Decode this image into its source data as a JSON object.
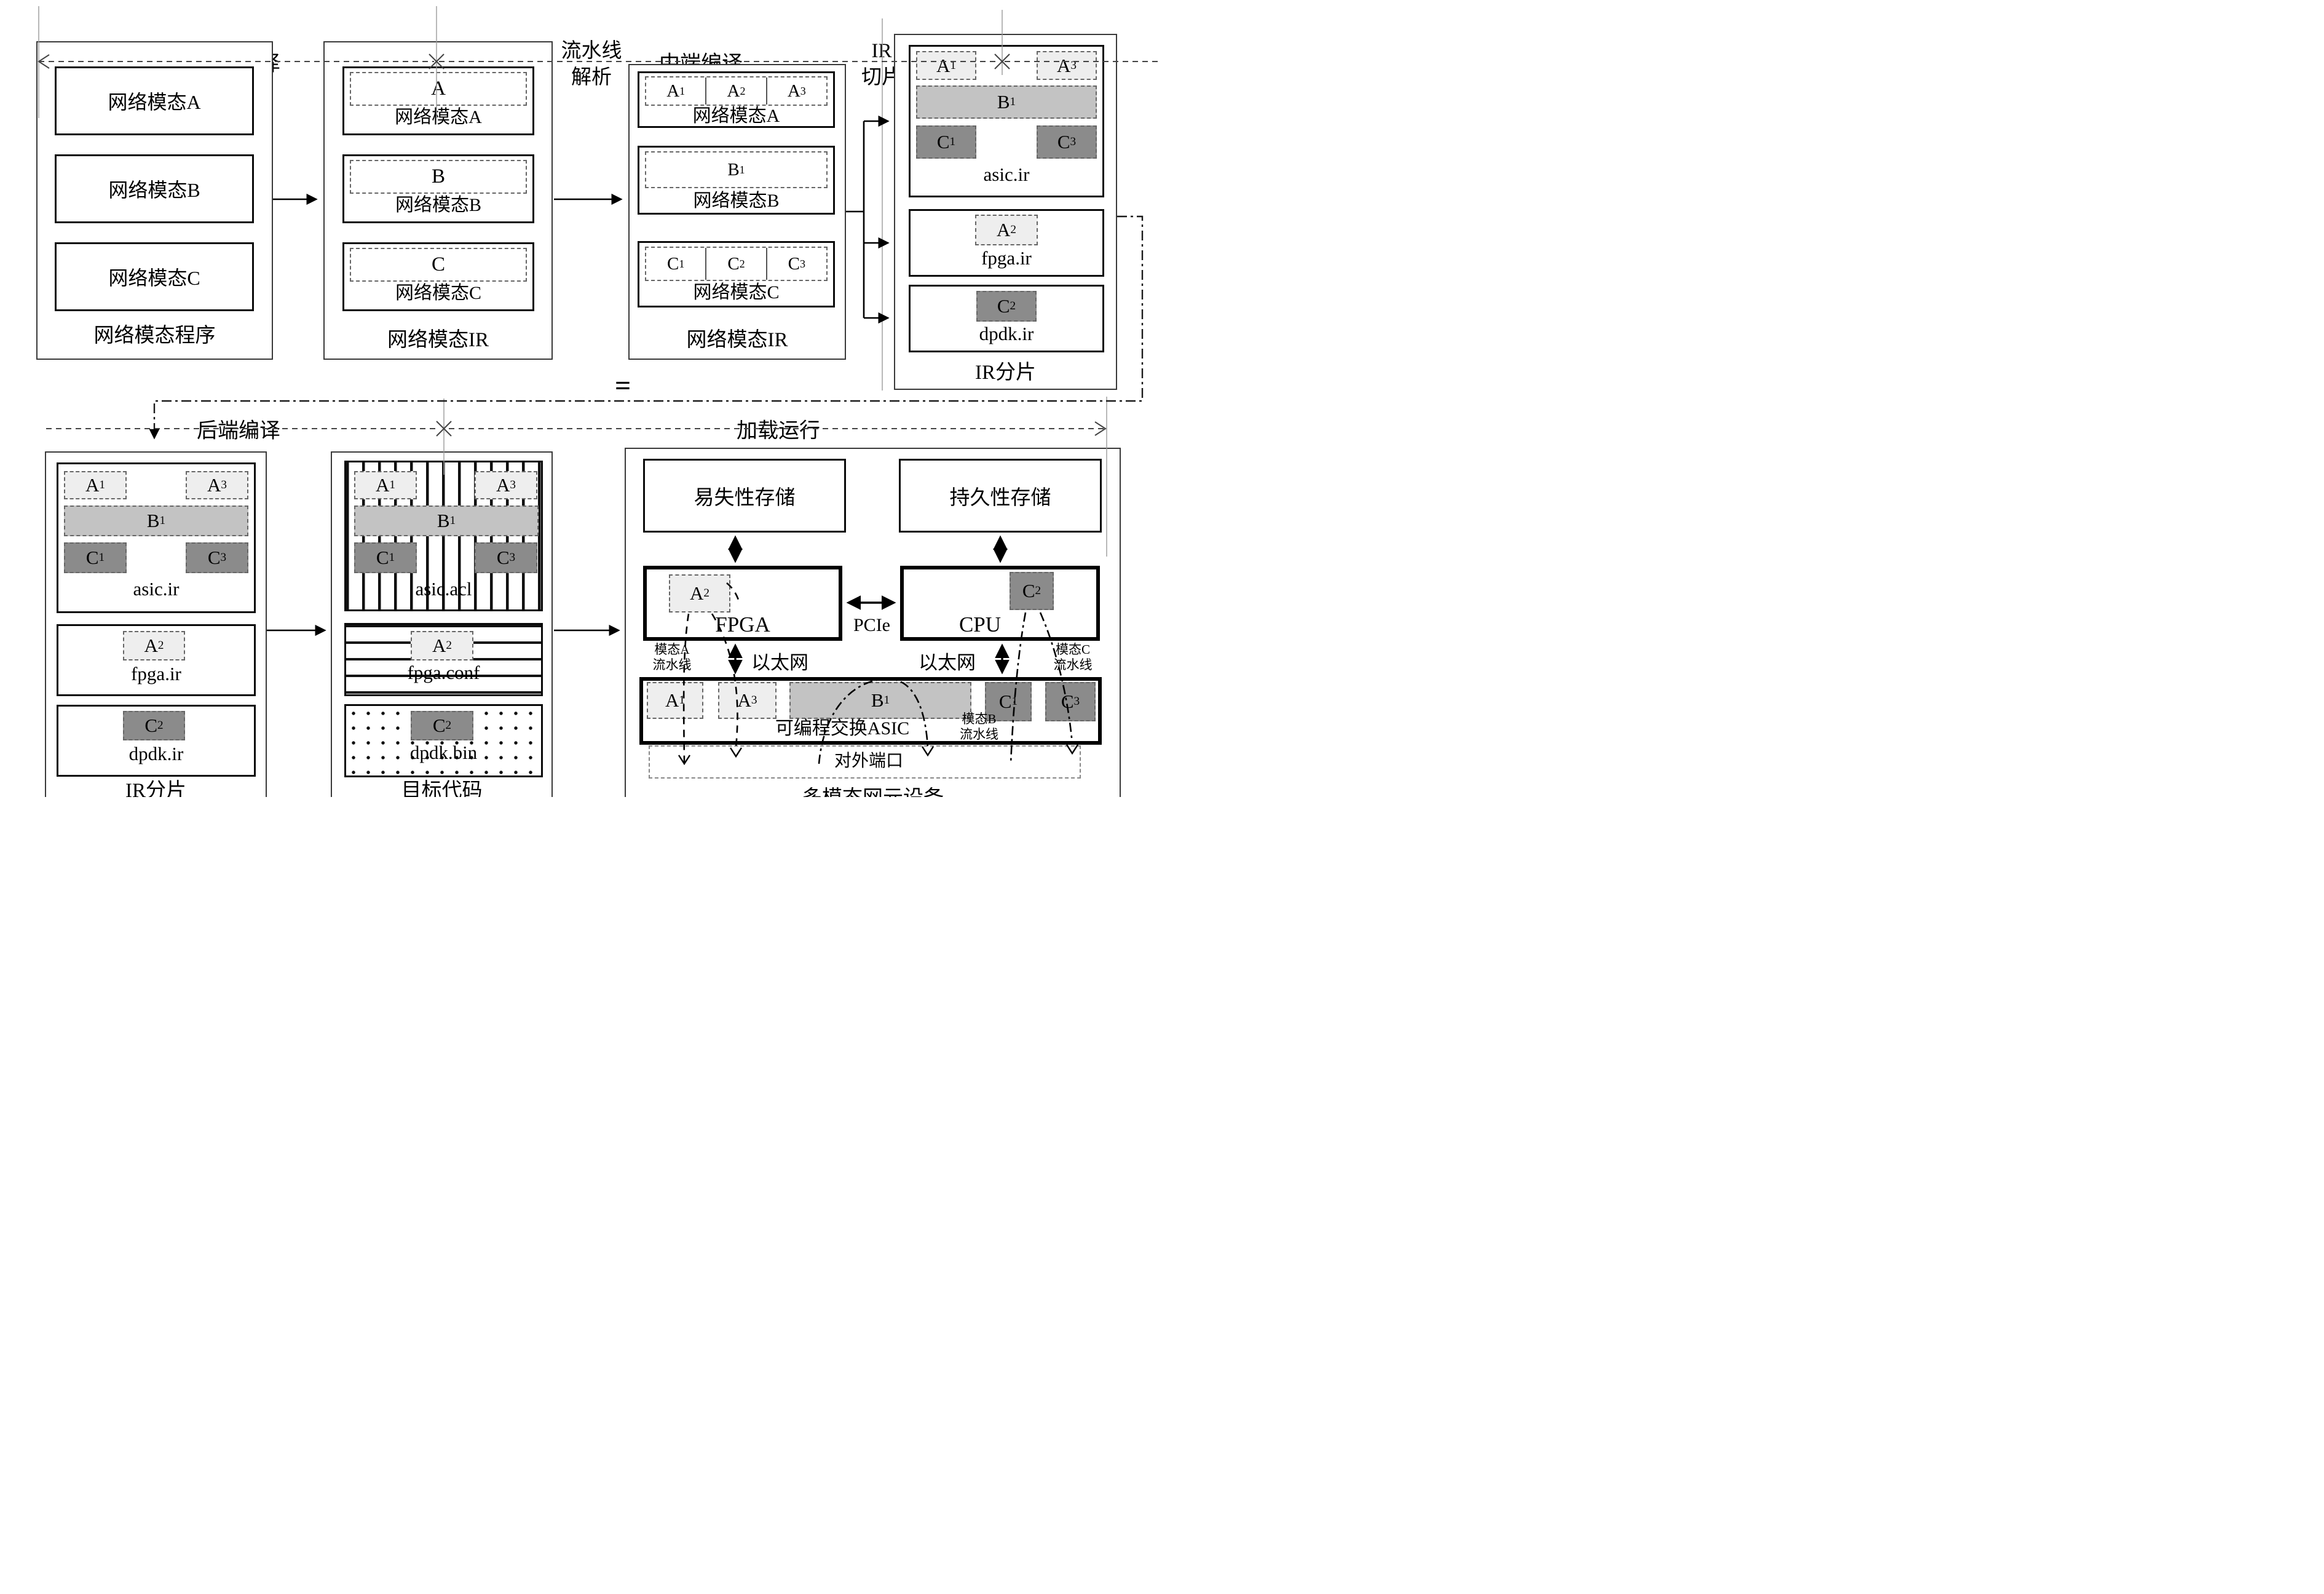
{
  "units": {
    "a": {
      "b": "A",
      "s": ""
    },
    "b": {
      "b": "B",
      "s": ""
    },
    "c": {
      "b": "C",
      "s": ""
    },
    "a1": {
      "b": "A",
      "s": "1"
    },
    "a2": {
      "b": "A",
      "s": "2"
    },
    "a3": {
      "b": "A",
      "s": "3"
    },
    "b1": {
      "b": "B",
      "s": "1"
    },
    "c1": {
      "b": "C",
      "s": "1"
    },
    "c2": {
      "b": "C",
      "s": "2"
    },
    "c3": {
      "b": "C",
      "s": "3"
    }
  },
  "phases": {
    "frontend": "前端编译",
    "midend": "中端编译",
    "backend": "后端编译",
    "load_run": "加载运行"
  },
  "annotations": {
    "pipeline_parse_l1": "流水线",
    "pipeline_parse_l2": "解析",
    "ir_slice_l1": "IR",
    "ir_slice_l2": "切片",
    "equals": "="
  },
  "program_box": {
    "caption": "网络模态程序",
    "items": [
      "网络模态A",
      "网络模态B",
      "网络模态C"
    ]
  },
  "ir_box": {
    "caption": "网络模态IR",
    "items": [
      "网络模态A",
      "网络模态B",
      "网络模态C"
    ]
  },
  "pipe_box": {
    "caption": "网络模态IR",
    "items": [
      "网络模态A",
      "网络模态B",
      "网络模态C"
    ]
  },
  "shard_box": {
    "caption": "IR分片",
    "files": [
      "asic.ir",
      "fpga.ir",
      "dpdk.ir"
    ]
  },
  "target_box": {
    "caption": "目标代码",
    "files": [
      "asic.acl",
      "fpga.conf",
      "dpdk.bin"
    ]
  },
  "device": {
    "caption": "多模态网元设备",
    "volatile": "易失性存储",
    "persistent": "持久性存储",
    "fpga": "FPGA",
    "cpu": "CPU",
    "pcie": "PCIe",
    "ethernet_left": "以太网",
    "ethernet_right": "以太网",
    "asic": "可编程交换ASIC",
    "ports": "对外端口",
    "pipeline_a_l1": "模态A",
    "pipeline_a_l2": "流水线",
    "pipeline_b_l1": "模态B",
    "pipeline_b_l2": "流水线",
    "pipeline_c_l1": "模态C",
    "pipeline_c_l2": "流水线"
  }
}
